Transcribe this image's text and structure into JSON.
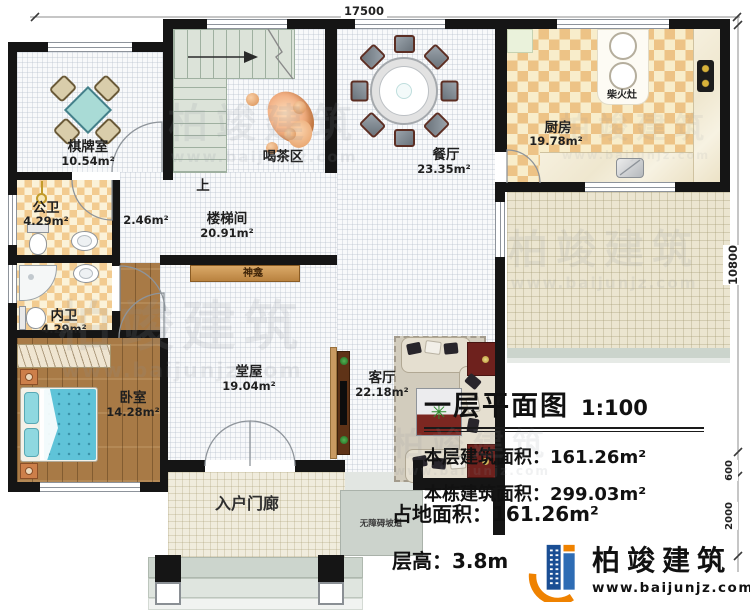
{
  "dimensions": {
    "top_width": "17500",
    "right_height": "10800",
    "right_step": "600",
    "right_porch": "2000"
  },
  "rooms": {
    "qipaishi": {
      "name": "棋牌室",
      "area": "10.54m²"
    },
    "gongwei": {
      "name": "公卫",
      "area": "4.29m²"
    },
    "neiwei": {
      "name": "内卫",
      "area": "4.29m²"
    },
    "woshi": {
      "name": "卧室",
      "area": "14.28m²"
    },
    "loutijian": {
      "name": "楼梯间",
      "area": "20.91m²"
    },
    "nook": {
      "area": "2.46m²"
    },
    "hechaqu": {
      "name": "喝茶区"
    },
    "shang": {
      "name": "上"
    },
    "shenkan": {
      "name": "神龛"
    },
    "tangwu": {
      "name": "堂屋",
      "area": "19.04m²"
    },
    "keting": {
      "name": "客厅",
      "area": "22.18m²"
    },
    "canting": {
      "name": "餐厅",
      "area": "23.35m²"
    },
    "chufang": {
      "name": "厨房",
      "area": "19.78m²"
    },
    "chaihuozao": {
      "name": "柴火灶"
    },
    "ruhumenlang": {
      "name": "入户门廊"
    },
    "wuzhangai": {
      "name": "无障碍坡道"
    }
  },
  "title_block": {
    "title": "一层平面图",
    "scale": "1:100",
    "line1_label": "本层建筑面积：",
    "line1_value": "161.26m²",
    "line2_label": "本栋建筑面积：",
    "line2_value": "299.03m²",
    "line3_label": "占地面积：",
    "line3_value": "161.26m²",
    "line4_label": "层高：",
    "line4_value": "3.8m"
  },
  "logo": {
    "name": "柏竣建筑",
    "website": "www.baijunjz.com"
  },
  "watermark": {
    "text": "柏竣建筑",
    "url": "www.baijunjz.com"
  }
}
